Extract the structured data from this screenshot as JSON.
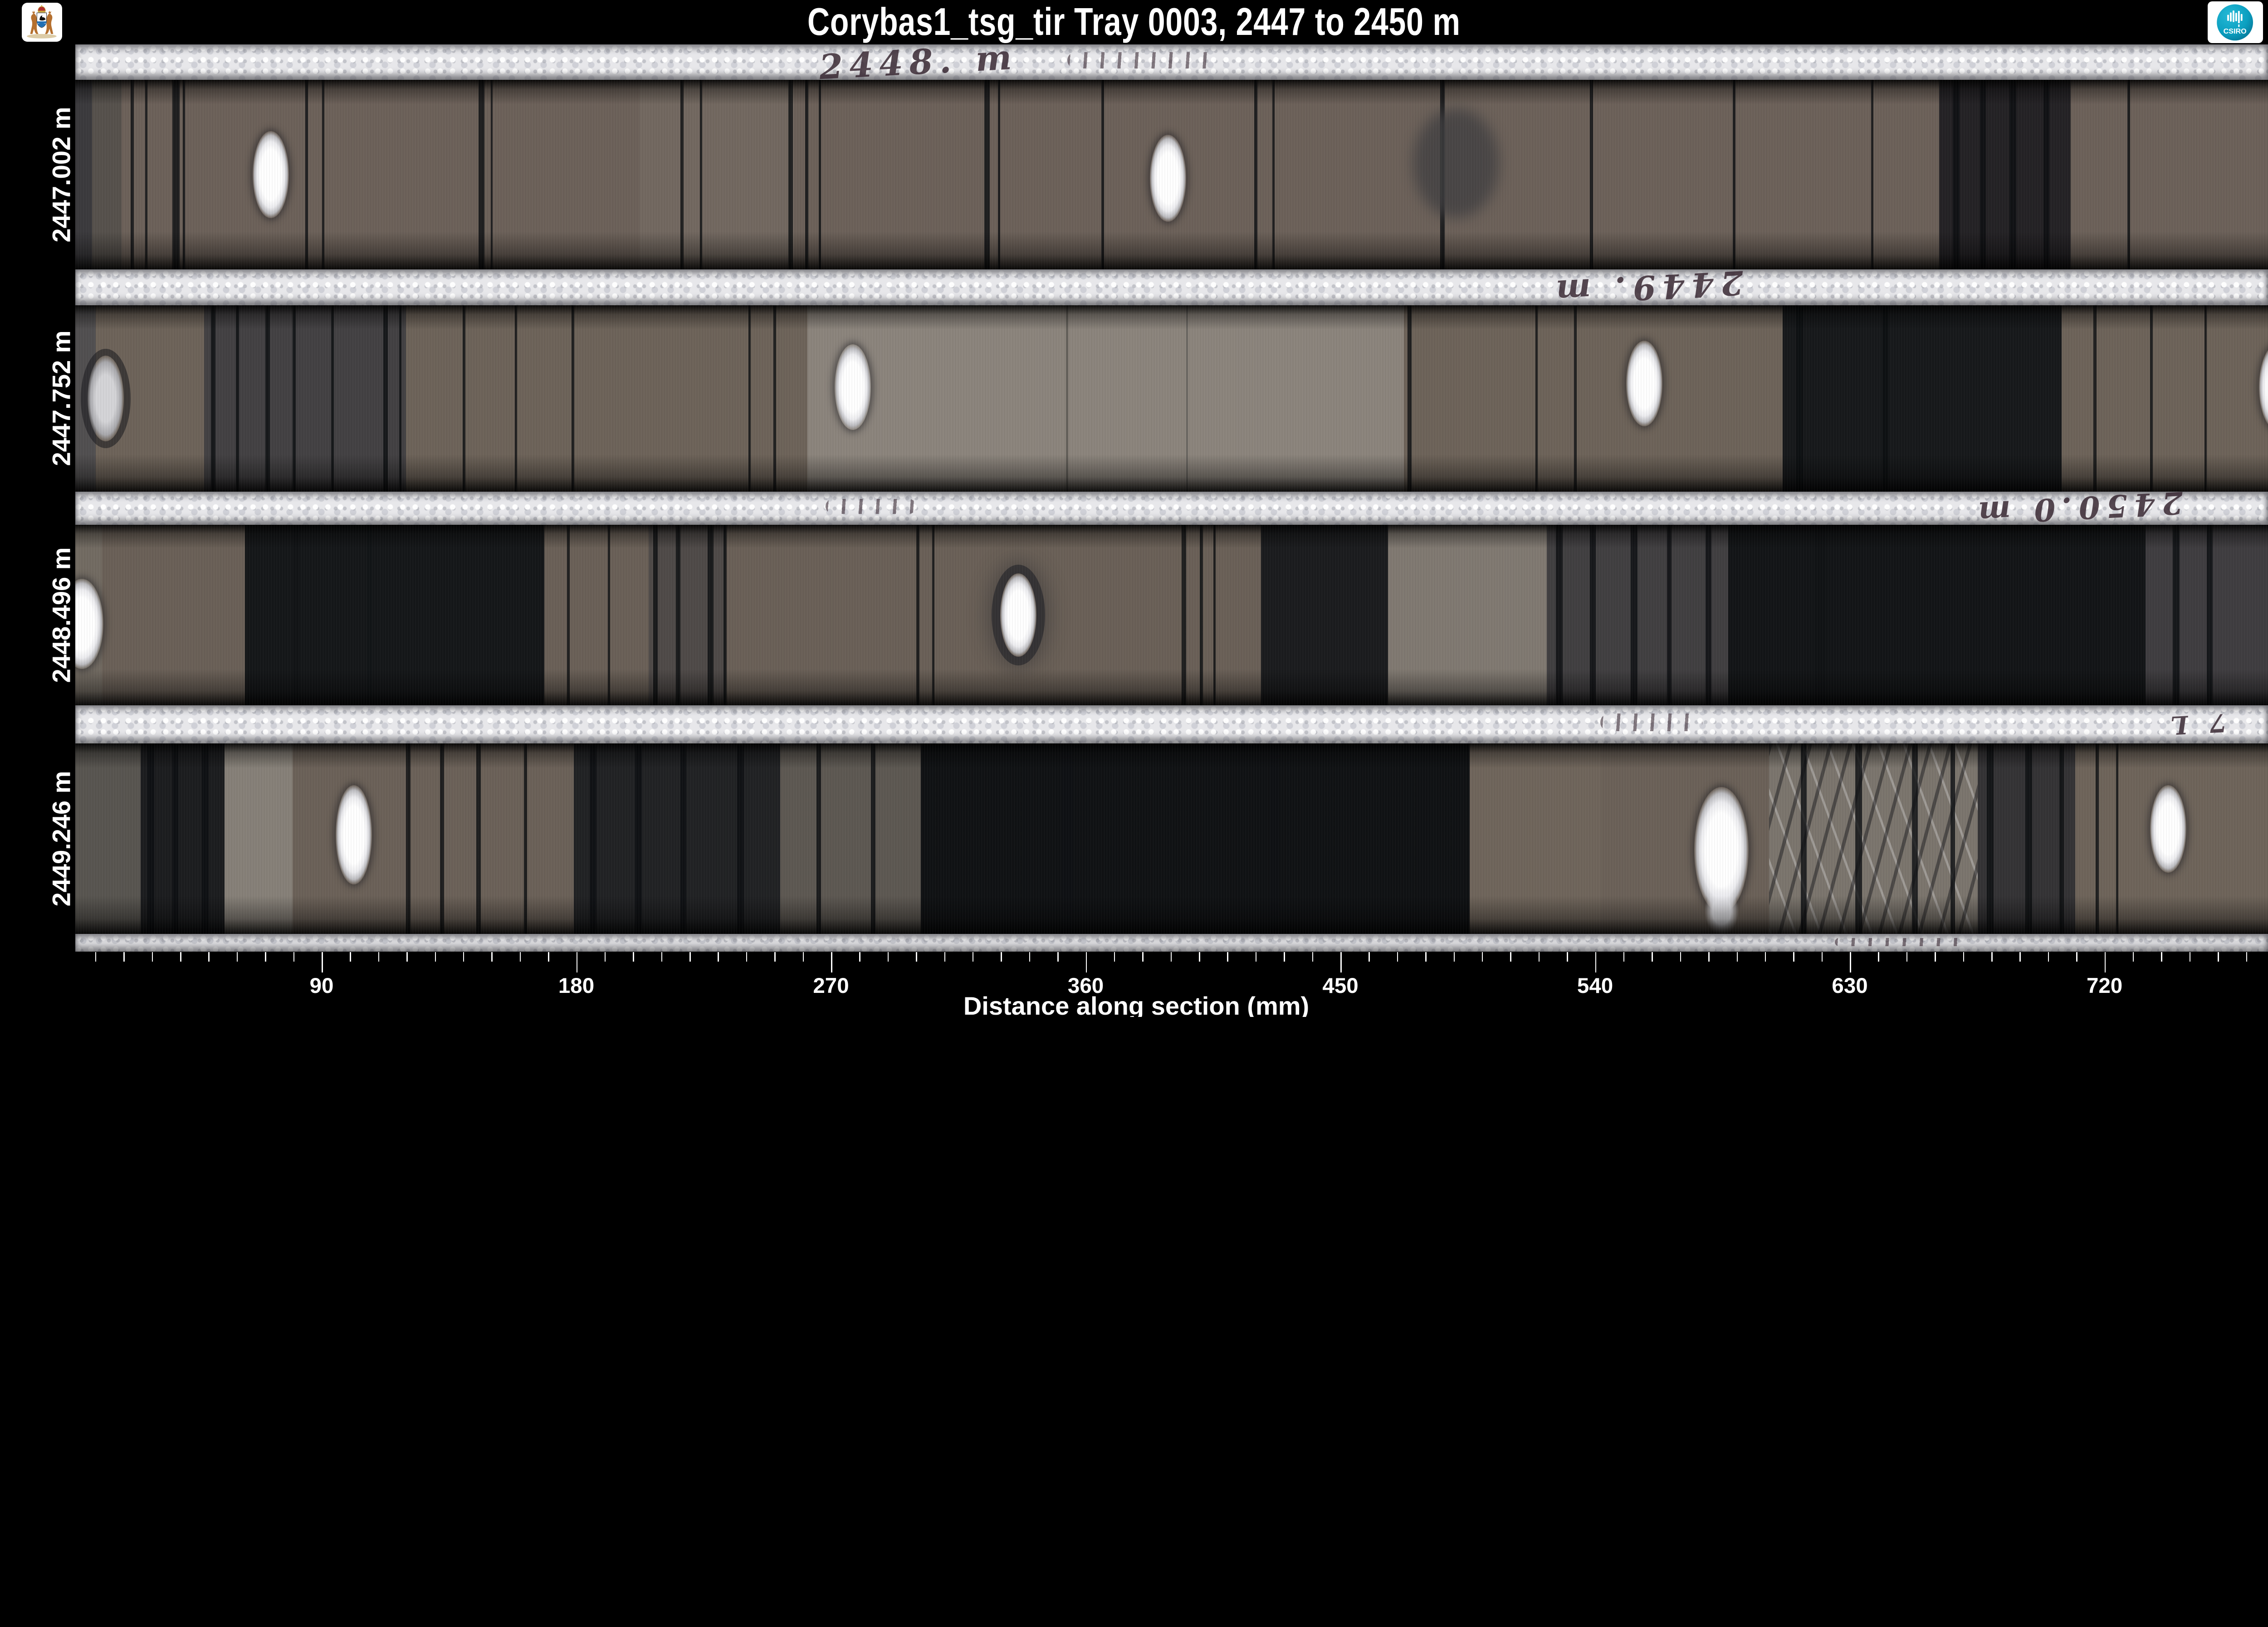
{
  "header": {
    "title": "Corybas1_tsg_tir  Tray 0003,  2447 to 2450 m",
    "csiro_text": "CSIRO",
    "logo_left_icon": "wa-coat-of-arms-icon",
    "logo_right_icon": "csiro-logo-icon"
  },
  "colors": {
    "background": "#000000",
    "text": "#ffffff",
    "foam": "#e7e7ea",
    "core_base": "#6b6158",
    "core_black": "#0e1013",
    "core_light": "#8b847c",
    "csiro_teal": "#0b9fc0",
    "handwriting": "#3a2a34"
  },
  "layout": {
    "plot_left": 3.31,
    "header_h": 4.38,
    "axis_top": 93.63
  },
  "axis": {
    "label": "Distance along section (mm)",
    "x0_pct": 2.95,
    "pct_per_mm": 0.12478,
    "minor_from": 10,
    "minor_to": 770,
    "minor_step": 10,
    "major_every": 90,
    "major_ticks": [
      90,
      180,
      270,
      360,
      450,
      540,
      630,
      720
    ]
  },
  "chart_data": {
    "type": "heatmap",
    "title": "Corybas1_tsg_tir  Tray 0003,  2447 to 2450 m",
    "subtitle": "Core tray photograph montage, 4 core rows",
    "xlabel": "Distance along section (mm)",
    "x_ticks": [
      90,
      180,
      270,
      360,
      450,
      540,
      630,
      720
    ],
    "x_range_mm": [
      0,
      775
    ],
    "depth_range_m": [
      2447,
      2450
    ],
    "tray": "0003",
    "dataset": "Corybas1_tsg_tir",
    "rows": [
      {
        "row": 1,
        "start_depth_m": 2447.002
      },
      {
        "row": 2,
        "start_depth_m": 2447.752
      },
      {
        "row": 3,
        "start_depth_m": 2448.496
      },
      {
        "row": 4,
        "start_depth_m": 2449.246
      }
    ],
    "legend": "none",
    "grid": false
  },
  "rows": [
    {
      "name": "row1",
      "label": "2447.002 m",
      "top": 7.87,
      "h": 18.61,
      "base": "#6c6159",
      "bands": [
        {
          "x": 3.31,
          "w": 0.75,
          "c": "#37373b",
          "o": 0.92
        },
        {
          "x": 4.06,
          "w": 1.3,
          "c": "#514d49",
          "o": 0.8
        },
        {
          "x": 28.2,
          "w": 6.8,
          "c": "#787067",
          "o": 0.5
        },
        {
          "x": 85.5,
          "w": 5.8,
          "c": "#17181c",
          "o": 0.85
        }
      ],
      "streaks": [
        [
          5.75,
          0.14
        ],
        [
          6.4,
          0.1
        ],
        [
          7.6,
          0.32
        ],
        [
          8.05,
          0.1
        ],
        [
          13.45,
          0.12
        ],
        [
          14.2,
          0.1
        ],
        [
          21.1,
          0.26
        ],
        [
          21.65,
          0.08
        ],
        [
          30.0,
          0.14
        ],
        [
          30.85,
          0.1
        ],
        [
          34.75,
          0.2
        ],
        [
          35.5,
          0.14
        ],
        [
          36.1,
          0.1
        ],
        [
          43.4,
          0.24
        ],
        [
          44.0,
          0.1
        ],
        [
          48.55,
          0.12
        ],
        [
          55.3,
          0.14
        ],
        [
          56.1,
          0.1
        ],
        [
          63.5,
          0.2
        ],
        [
          70.1,
          0.14
        ],
        [
          76.4,
          0.12
        ],
        [
          82.5,
          0.1
        ],
        [
          86.1,
          0.3
        ],
        [
          87.3,
          0.25
        ],
        [
          88.6,
          0.3
        ],
        [
          90.1,
          0.25
        ],
        [
          93.8,
          0.12
        ]
      ],
      "blobs": [
        {
          "x": 64.2,
          "y": 44,
          "w": 3.8,
          "h": 58,
          "c": "#403f41",
          "o": 0.78
        }
      ],
      "ovals": [
        {
          "x": 11.94,
          "y": 50
        },
        {
          "x": 51.5,
          "y": 52
        }
      ]
    },
    {
      "name": "row2",
      "label": "2447.752 m",
      "top": 30.02,
      "h": 18.32,
      "base": "#6d6359",
      "bands": [
        {
          "x": 3.31,
          "w": 0.9,
          "c": "#4a4a4e",
          "o": 0.8
        },
        {
          "x": 9.0,
          "w": 8.9,
          "c": "#3c3b3f",
          "o": 0.85
        },
        {
          "x": 35.6,
          "w": 26.3,
          "c": "#8b847c",
          "o": 1
        },
        {
          "x": 78.6,
          "w": 12.3,
          "c": "#101216",
          "o": 0.92
        }
      ],
      "streaks": [
        [
          9.3,
          0.2
        ],
        [
          10.4,
          0.15
        ],
        [
          11.7,
          0.2
        ],
        [
          12.9,
          0.15
        ],
        [
          14.6,
          0.12
        ],
        [
          16.9,
          0.2
        ],
        [
          17.6,
          0.1
        ],
        [
          20.4,
          0.12
        ],
        [
          22.7,
          0.1
        ],
        [
          25.2,
          0.12
        ],
        [
          33.0,
          0.1
        ],
        [
          34.1,
          0.12
        ],
        [
          47.0,
          0.1,
          0.3
        ],
        [
          52.3,
          0.08,
          0.25
        ],
        [
          62.05,
          0.18
        ],
        [
          67.7,
          0.1
        ],
        [
          69.4,
          0.12
        ],
        [
          79.2,
          0.3
        ],
        [
          83.0,
          0.25
        ],
        [
          92.3,
          0.15
        ],
        [
          94.8,
          0.12
        ],
        [
          97.2,
          0.1
        ]
      ],
      "blobs": [],
      "ovals": [
        {
          "x": 4.65,
          "y": 50,
          "fill": "dim"
        },
        {
          "x": 37.6,
          "y": 44
        },
        {
          "x": 72.5,
          "y": 42
        },
        {
          "x": 100.4,
          "y": 44
        }
      ]
    },
    {
      "name": "row3",
      "label": "2448.496 m",
      "top": 51.6,
      "h": 17.76,
      "base": "#6a6057",
      "bands": [
        {
          "x": 3.31,
          "w": 1.2,
          "c": "#767067",
          "o": 0.7
        },
        {
          "x": 10.8,
          "w": 13.2,
          "c": "#0f1114",
          "o": 0.93
        },
        {
          "x": 28.6,
          "w": 3.4,
          "c": "#4a4745",
          "o": 0.85
        },
        {
          "x": 55.6,
          "w": 5.6,
          "c": "#131518",
          "o": 0.9
        },
        {
          "x": 61.2,
          "w": 7.0,
          "c": "#837c74",
          "o": 0.9
        },
        {
          "x": 68.2,
          "w": 8.0,
          "c": "#3a393d",
          "o": 0.85
        },
        {
          "x": 76.2,
          "w": 18.4,
          "c": "#0e1013",
          "o": 0.94
        },
        {
          "x": 94.6,
          "w": 5.4,
          "c": "#3b3a3e",
          "o": 0.9
        }
      ],
      "streaks": [
        [
          12.9,
          0.3,
          0.35
        ],
        [
          16.2,
          0.2,
          0.25
        ],
        [
          25.0,
          0.12
        ],
        [
          26.8,
          0.1
        ],
        [
          28.8,
          0.2
        ],
        [
          29.8,
          0.2
        ],
        [
          31.2,
          0.25
        ],
        [
          31.9,
          0.15
        ],
        [
          40.4,
          0.15
        ],
        [
          41.1,
          0.1
        ],
        [
          52.1,
          0.2
        ],
        [
          52.9,
          0.15
        ],
        [
          53.5,
          0.1
        ],
        [
          68.6,
          0.3
        ],
        [
          70.1,
          0.25
        ],
        [
          71.9,
          0.3
        ],
        [
          73.5,
          0.2
        ],
        [
          75.2,
          0.25
        ],
        [
          80.0,
          0.5,
          0.3
        ],
        [
          95.8,
          0.3
        ],
        [
          97.3,
          0.25
        ]
      ],
      "blobs": [],
      "ovals": [
        {
          "x": 3.6,
          "y": 55,
          "w": 1.9,
          "h": 50
        },
        {
          "x": 44.9,
          "y": 50,
          "halo": true
        }
      ]
    },
    {
      "name": "row4",
      "label": "2449.246 m",
      "top": 73.1,
      "h": 18.73,
      "base": "#6b6158",
      "bands": [
        {
          "x": 3.31,
          "w": 2.9,
          "c": "#565450",
          "o": 0.9
        },
        {
          "x": 6.2,
          "w": 3.7,
          "c": "#141619",
          "o": 0.9
        },
        {
          "x": 9.9,
          "w": 3.0,
          "c": "#8a847c",
          "o": 0.9
        },
        {
          "x": 25.3,
          "w": 9.1,
          "c": "#1a1c1f",
          "o": 0.9
        },
        {
          "x": 34.4,
          "w": 6.2,
          "c": "#5d5852",
          "o": 1
        },
        {
          "x": 40.6,
          "w": 24.5,
          "c": "#0d0f12",
          "o": 0.96
        },
        {
          "x": 64.8,
          "w": 5.8,
          "c": "#6f655b",
          "o": 1
        },
        {
          "x": 78.0,
          "w": 9.2,
          "c": "#7b756d",
          "o": 1,
          "rubble": true
        },
        {
          "x": 87.2,
          "w": 4.3,
          "c": "#2c2c30",
          "o": 0.88
        },
        {
          "x": 91.5,
          "w": 8.5,
          "c": "#6e645a",
          "o": 1
        }
      ],
      "streaks": [
        [
          6.5,
          0.3
        ],
        [
          7.6,
          0.25
        ],
        [
          8.9,
          0.3
        ],
        [
          17.9,
          0.2
        ],
        [
          19.4,
          0.18
        ],
        [
          21.0,
          0.2
        ],
        [
          23.1,
          0.15
        ],
        [
          26.0,
          0.3
        ],
        [
          28.0,
          0.3
        ],
        [
          30.0,
          0.25
        ],
        [
          32.5,
          0.3
        ],
        [
          36.0,
          0.2
        ],
        [
          38.4,
          0.2
        ],
        [
          46.8,
          0.5,
          0.25
        ],
        [
          56.0,
          0.4,
          0.2
        ],
        [
          79.4,
          0.25
        ],
        [
          81.8,
          0.3
        ],
        [
          84.3,
          0.25
        ],
        [
          86.0,
          0.2
        ],
        [
          87.6,
          0.3
        ],
        [
          89.3,
          0.3
        ],
        [
          90.8,
          0.2
        ],
        [
          92.4,
          0.15
        ],
        [
          93.3,
          0.1
        ]
      ],
      "blobs": [],
      "ovals": [
        {
          "x": 15.6,
          "y": 48,
          "h": 52
        },
        {
          "x": 75.9,
          "y": 56,
          "w": 2.4,
          "h": 66
        },
        {
          "x": 75.9,
          "y": 88,
          "w": 1.5,
          "h": 26,
          "fill": "soft"
        },
        {
          "x": 95.6,
          "y": 45
        }
      ]
    }
  ],
  "foams": [
    {
      "top": 4.38,
      "h": 3.49,
      "marks": [
        {
          "type": "text",
          "text": "2448. m",
          "x": 40.5,
          "flip": false,
          "size": 1.5
        },
        {
          "type": "smudge",
          "x": 50.3,
          "w": 6.5
        }
      ]
    },
    {
      "top": 26.48,
      "h": 3.54,
      "marks": [
        {
          "type": "text",
          "text": "2449. m",
          "x": 72.6,
          "flip": true,
          "size": 1.45
        }
      ]
    },
    {
      "top": 48.34,
      "h": 3.26,
      "marks": [
        {
          "type": "smudge",
          "x": 38.4,
          "w": 4.0
        },
        {
          "type": "text",
          "text": "2450.0 m",
          "x": 91.6,
          "flip": true,
          "size": 1.35
        }
      ]
    },
    {
      "top": 69.36,
      "h": 3.74,
      "marks": [
        {
          "type": "smudge",
          "x": 72.8,
          "w": 4.5
        },
        {
          "type": "text",
          "text": "7 L",
          "x": 96.8,
          "flip": true,
          "size": 1.1
        }
      ]
    },
    {
      "top": 91.83,
      "h": 1.76,
      "marks": [
        {
          "type": "smudge",
          "x": 83.9,
          "w": 6.0
        }
      ]
    }
  ]
}
